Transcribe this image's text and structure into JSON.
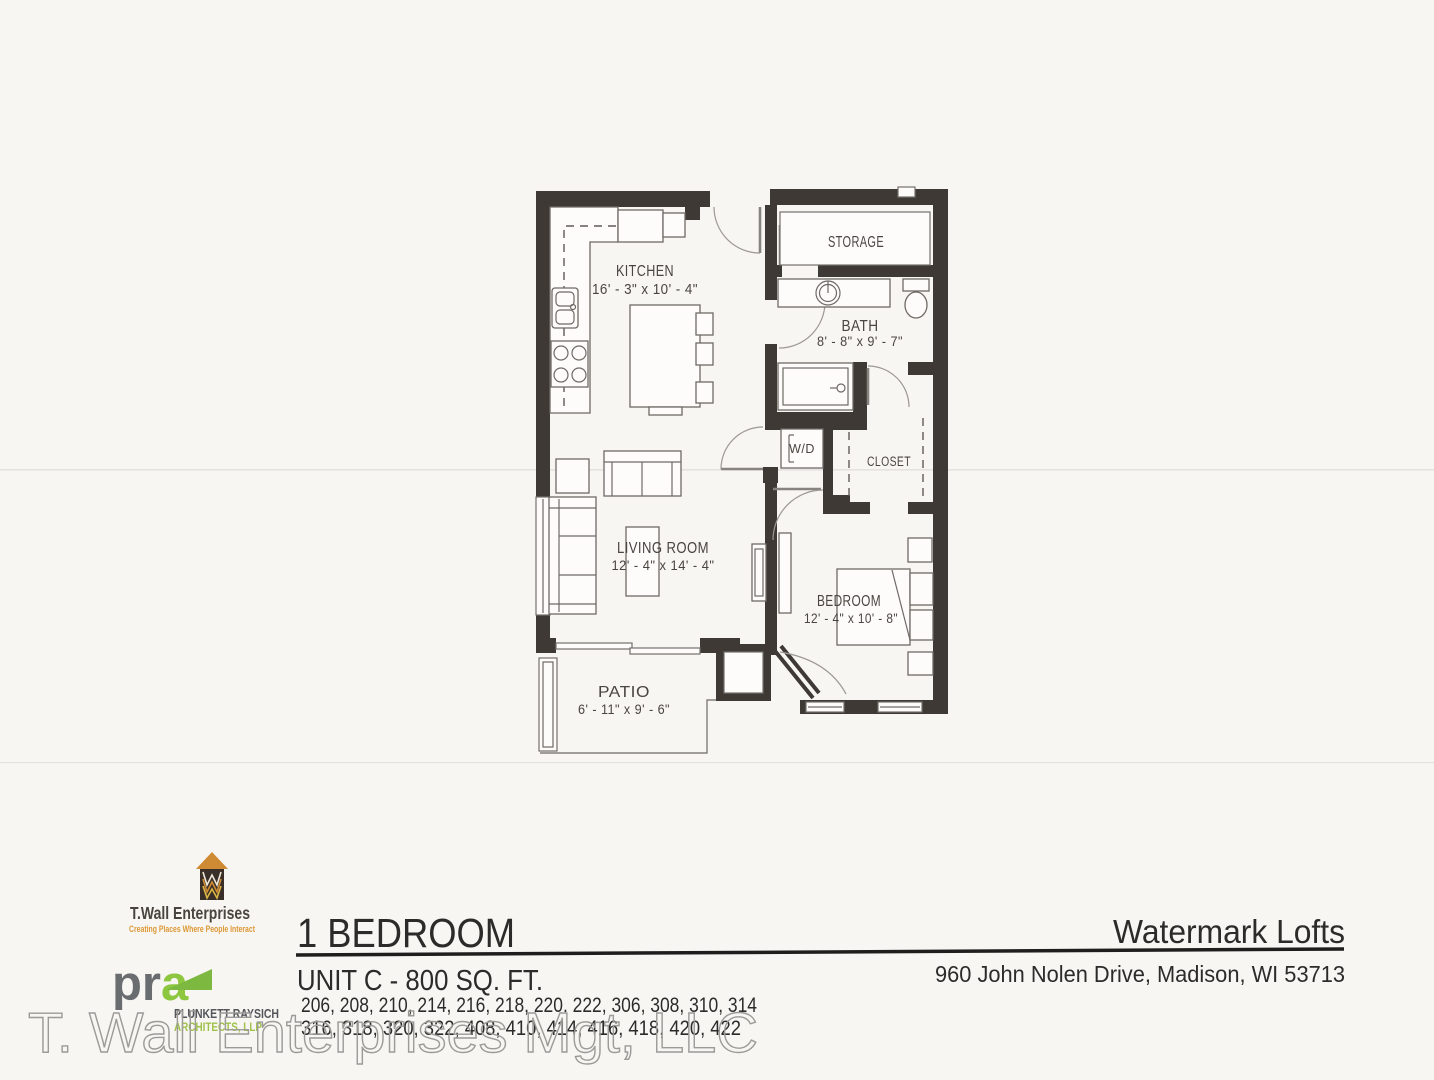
{
  "plan": {
    "rooms": {
      "kitchen": {
        "name": "KITCHEN",
        "dims": "16' - 3\" x 10' - 4\""
      },
      "storage": {
        "name": "STORAGE"
      },
      "bath": {
        "name": "BATH",
        "dims": "8' - 8\" x 9' - 7\""
      },
      "wd": {
        "name": "W/D"
      },
      "closet": {
        "name": "CLOSET"
      },
      "living": {
        "name": "LIVING ROOM",
        "dims": "12' - 4\" x 14' - 4\""
      },
      "bedroom": {
        "name": "BEDROOM",
        "dims": "12' - 4\" x 10' - 8\""
      },
      "patio": {
        "name": "PATIO",
        "dims": "6' - 11\" x 9' - 6\""
      }
    }
  },
  "footer": {
    "twall": {
      "name": "T.Wall Enterprises",
      "tagline": "Creating Places Where People Interact"
    },
    "pra": {
      "pr": "pr",
      "a": "a",
      "firm": "PLUNKETT RAYSICH",
      "suffix": "ARCHITECTS, LLP"
    },
    "unit": {
      "type": "1 BEDROOM",
      "size": "UNIT C - 800 SQ. FT.",
      "units_line1": "206, 208, 210, 214, 216, 218, 220. 222, 306, 308, 310, 314",
      "units_line2": "316, 318, 320, 322, 408, 410, 414, 416, 418, 420, 422"
    },
    "property": {
      "name": "Watermark Lofts",
      "address": "960 John Nolen Drive, Madison, WI 53713"
    },
    "watermark": "T. Wall Enterprises Mgt, LLC"
  },
  "colors": {
    "wall": "#3e3935",
    "accent_orange": "#dd9733",
    "accent_green": "#8dc63f",
    "logo_gray": "#6a6d70",
    "ink": "#2d2b29",
    "watermark_outline": "#9d9b98"
  }
}
